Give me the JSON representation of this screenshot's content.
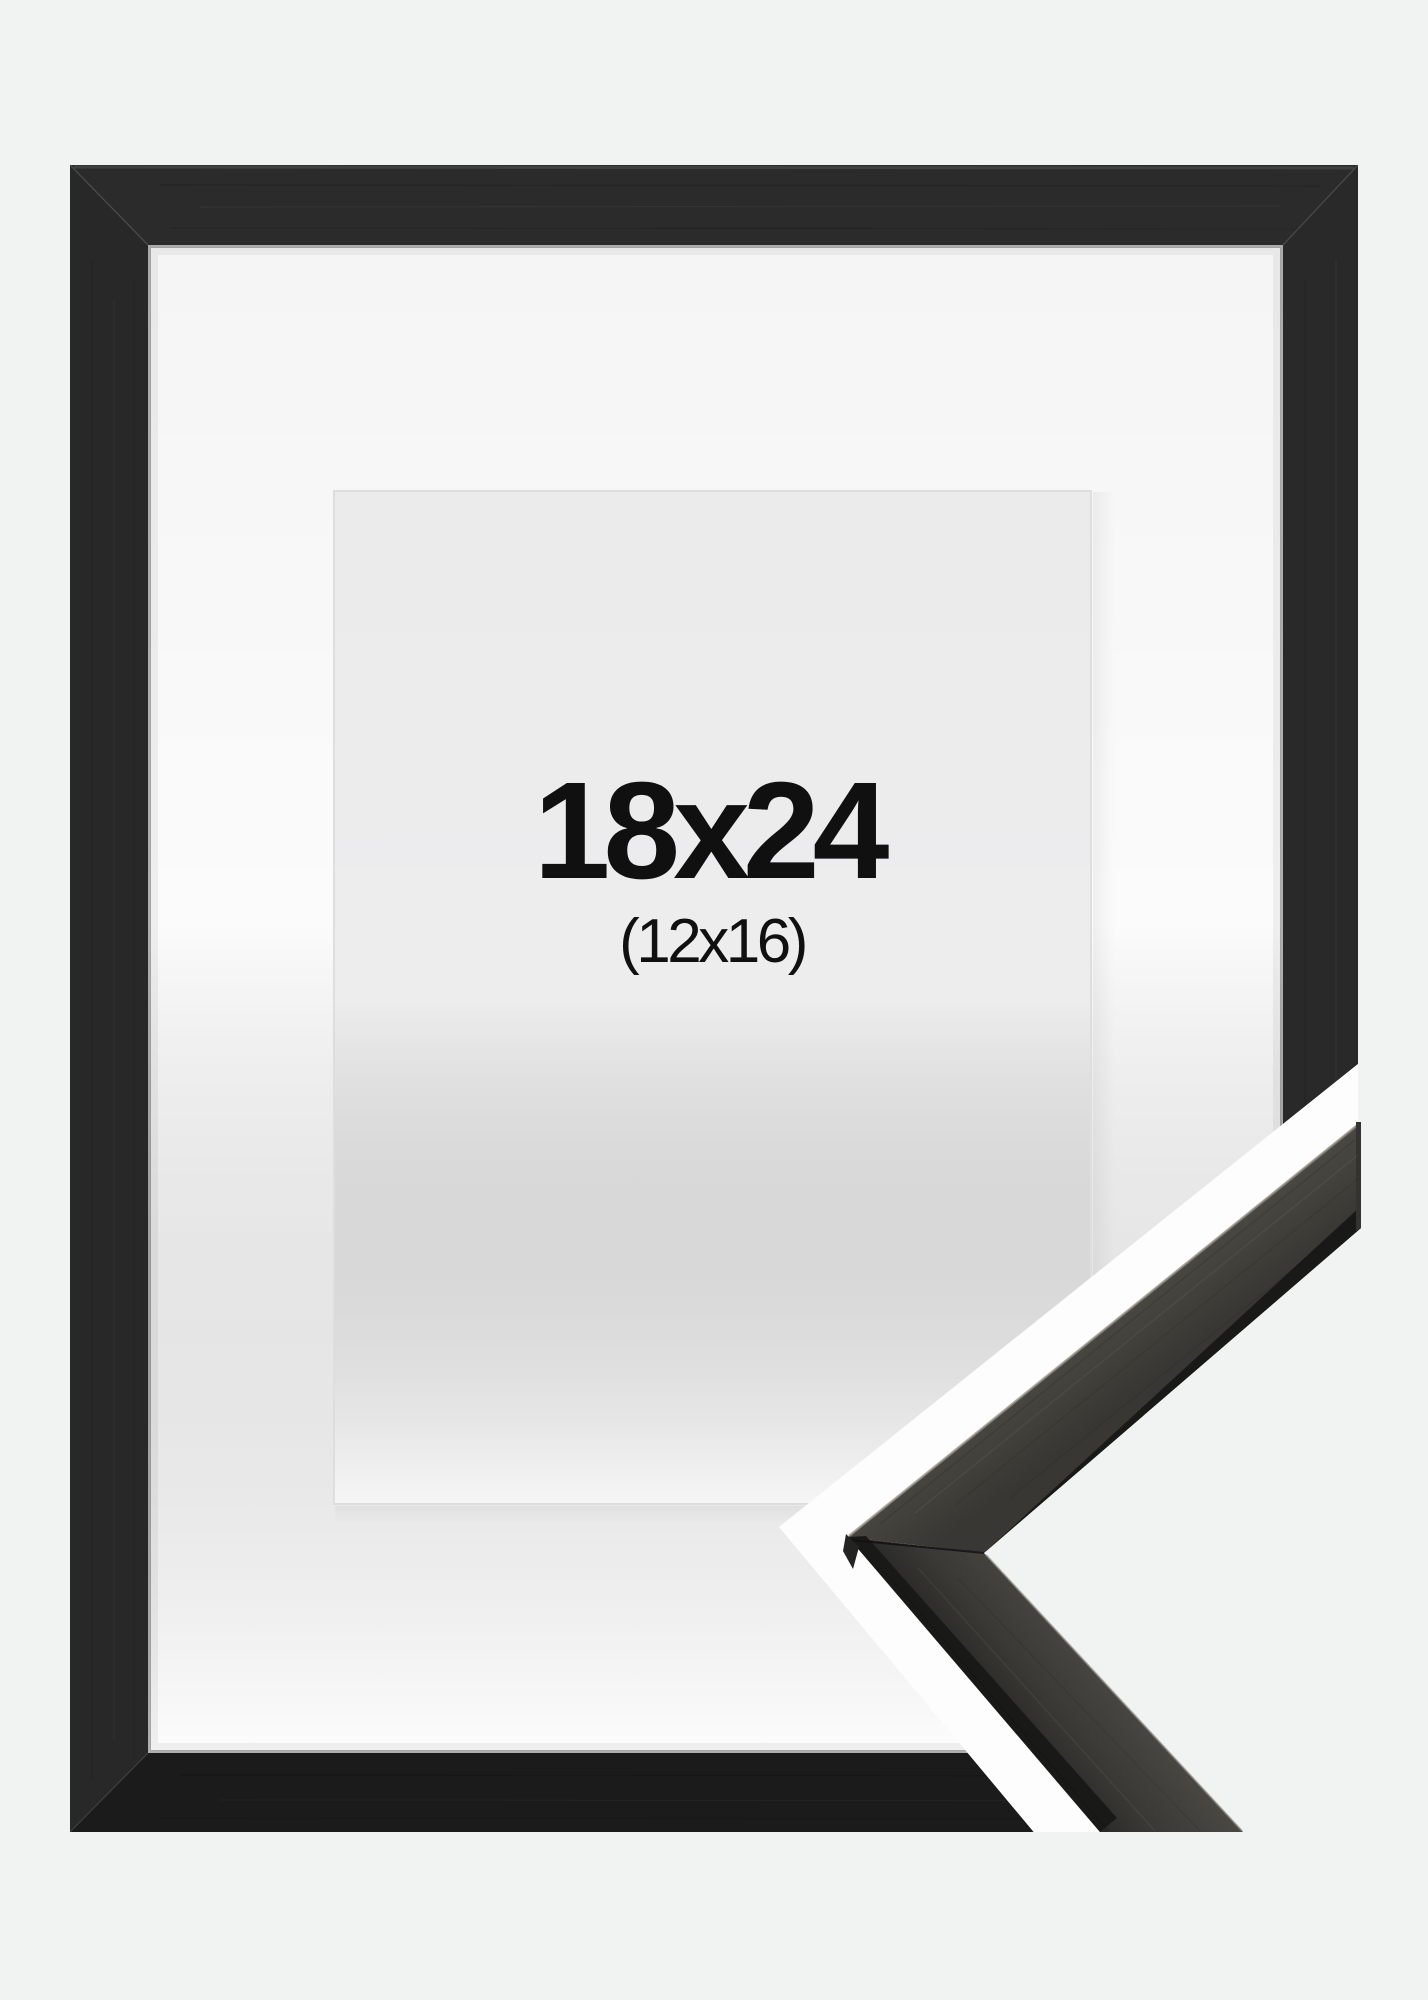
{
  "product_photo": {
    "size_label": "18x24",
    "matted_size_label": "(12x16)"
  },
  "colors": {
    "page_background": "#f1f2f2",
    "frame_top": "#2b2b2b",
    "frame_left": "#282828",
    "frame_right": "#292929",
    "frame_bottom": "#1b1b1b",
    "mat": "#fbfbfb",
    "opening": "#f0f0f1",
    "divider_band": "#fdfdfd",
    "sample_surface_light": "#57554f",
    "sample_surface_dark": "#2a2a28",
    "sample_edge": "#191918",
    "label_text": "#101010"
  }
}
